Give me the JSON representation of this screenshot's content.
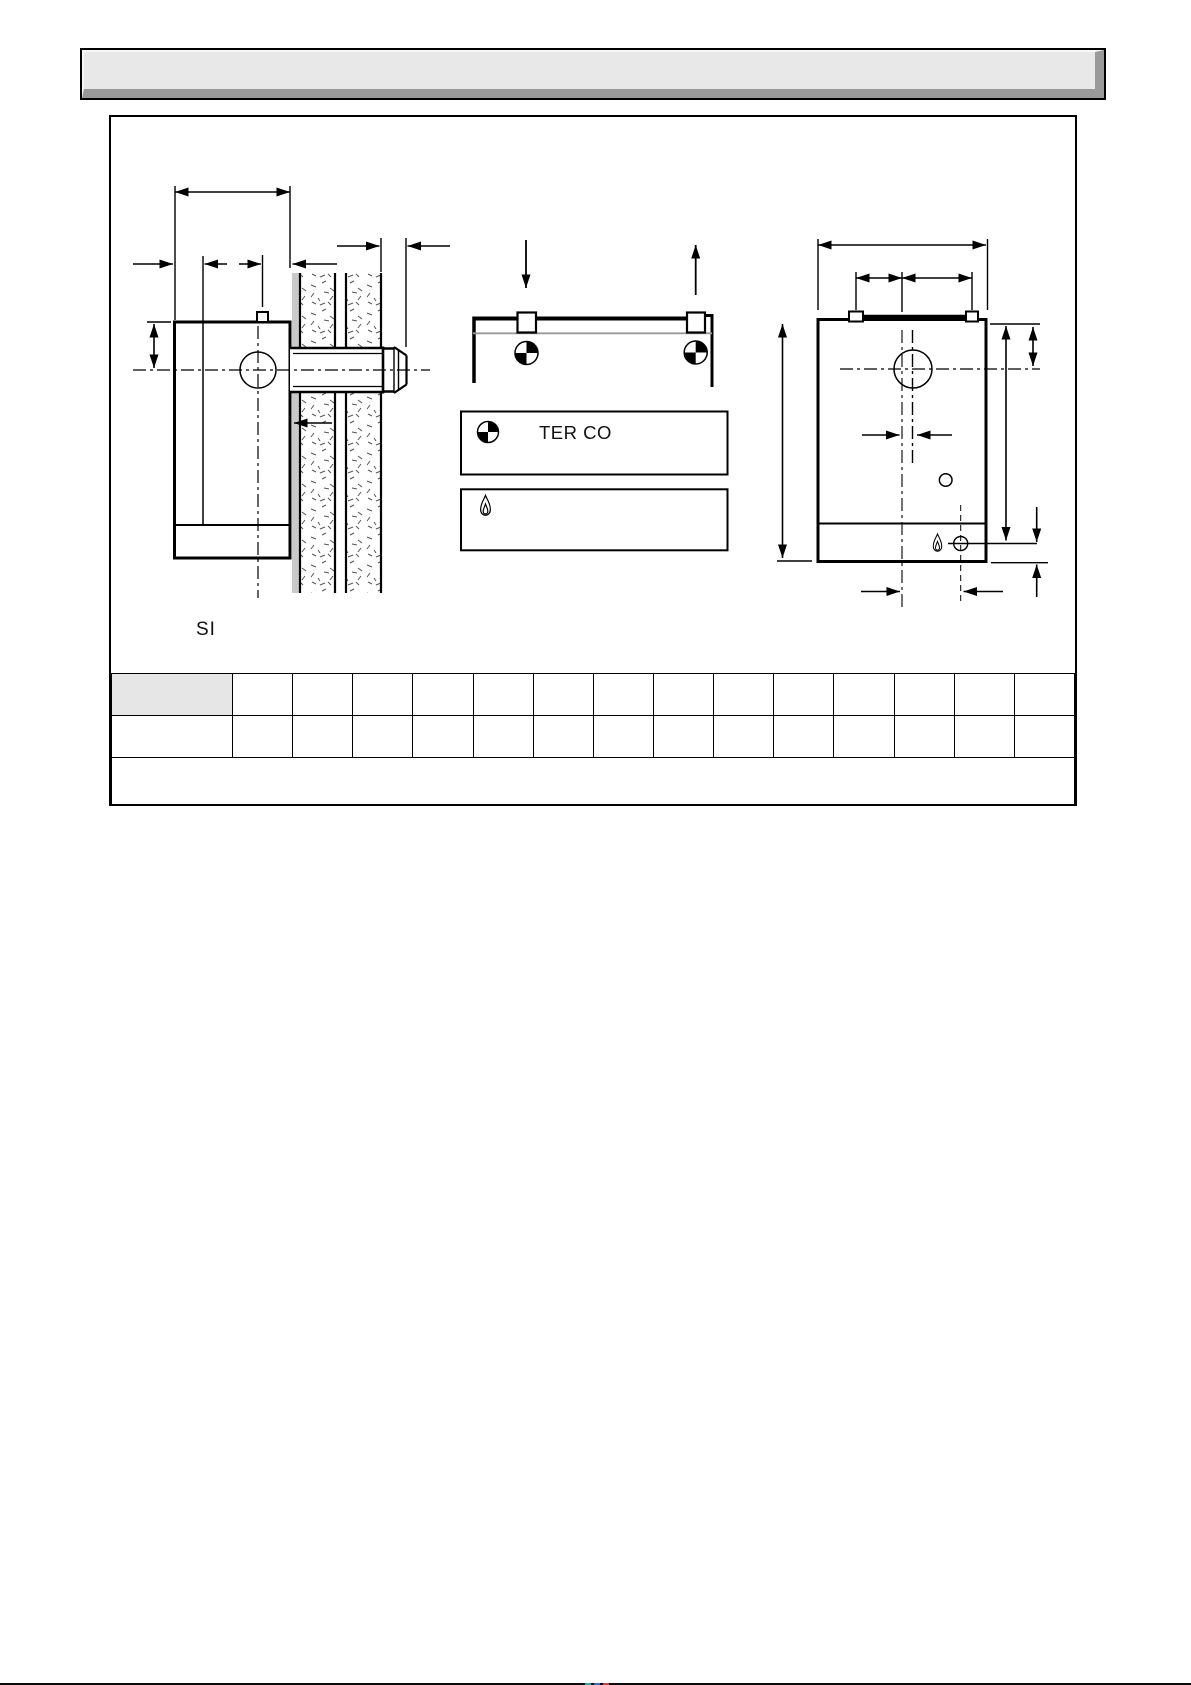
{
  "title_banner": {
    "text": ""
  },
  "figure": {
    "label_si": "SI",
    "legend": {
      "row1": {
        "icon": "datum-target-icon",
        "text": "TER CO"
      },
      "row2": {
        "icon": "gas-flame-icon",
        "text": ""
      }
    },
    "diagrams": {
      "left": "side-section-through-cavity-wall",
      "middle": "plan-view",
      "right": "front-view"
    }
  },
  "table": {
    "rows": [
      {
        "type": "header",
        "cells": [
          "",
          "",
          "",
          "",
          "",
          "",
          "",
          "",
          "",
          "",
          "",
          "",
          "",
          "",
          ""
        ]
      },
      {
        "type": "values",
        "cells": [
          "",
          "",
          "",
          "",
          "",
          "",
          "",
          "",
          "",
          "",
          "",
          "",
          "",
          "",
          ""
        ]
      },
      {
        "type": "footer",
        "cells": [
          ""
        ]
      }
    ]
  },
  "colors": {
    "line": "#000000",
    "banner_fill": "#e8e8e8",
    "banner_shadow": "#9a9a9a",
    "table_shade": "#e6e6e6",
    "plaster_gray": "#c9c9c9"
  },
  "scan_artifact": {
    "segment_colors": [
      "#2ba8a0",
      "#3a6cc8",
      "#c84040"
    ]
  }
}
